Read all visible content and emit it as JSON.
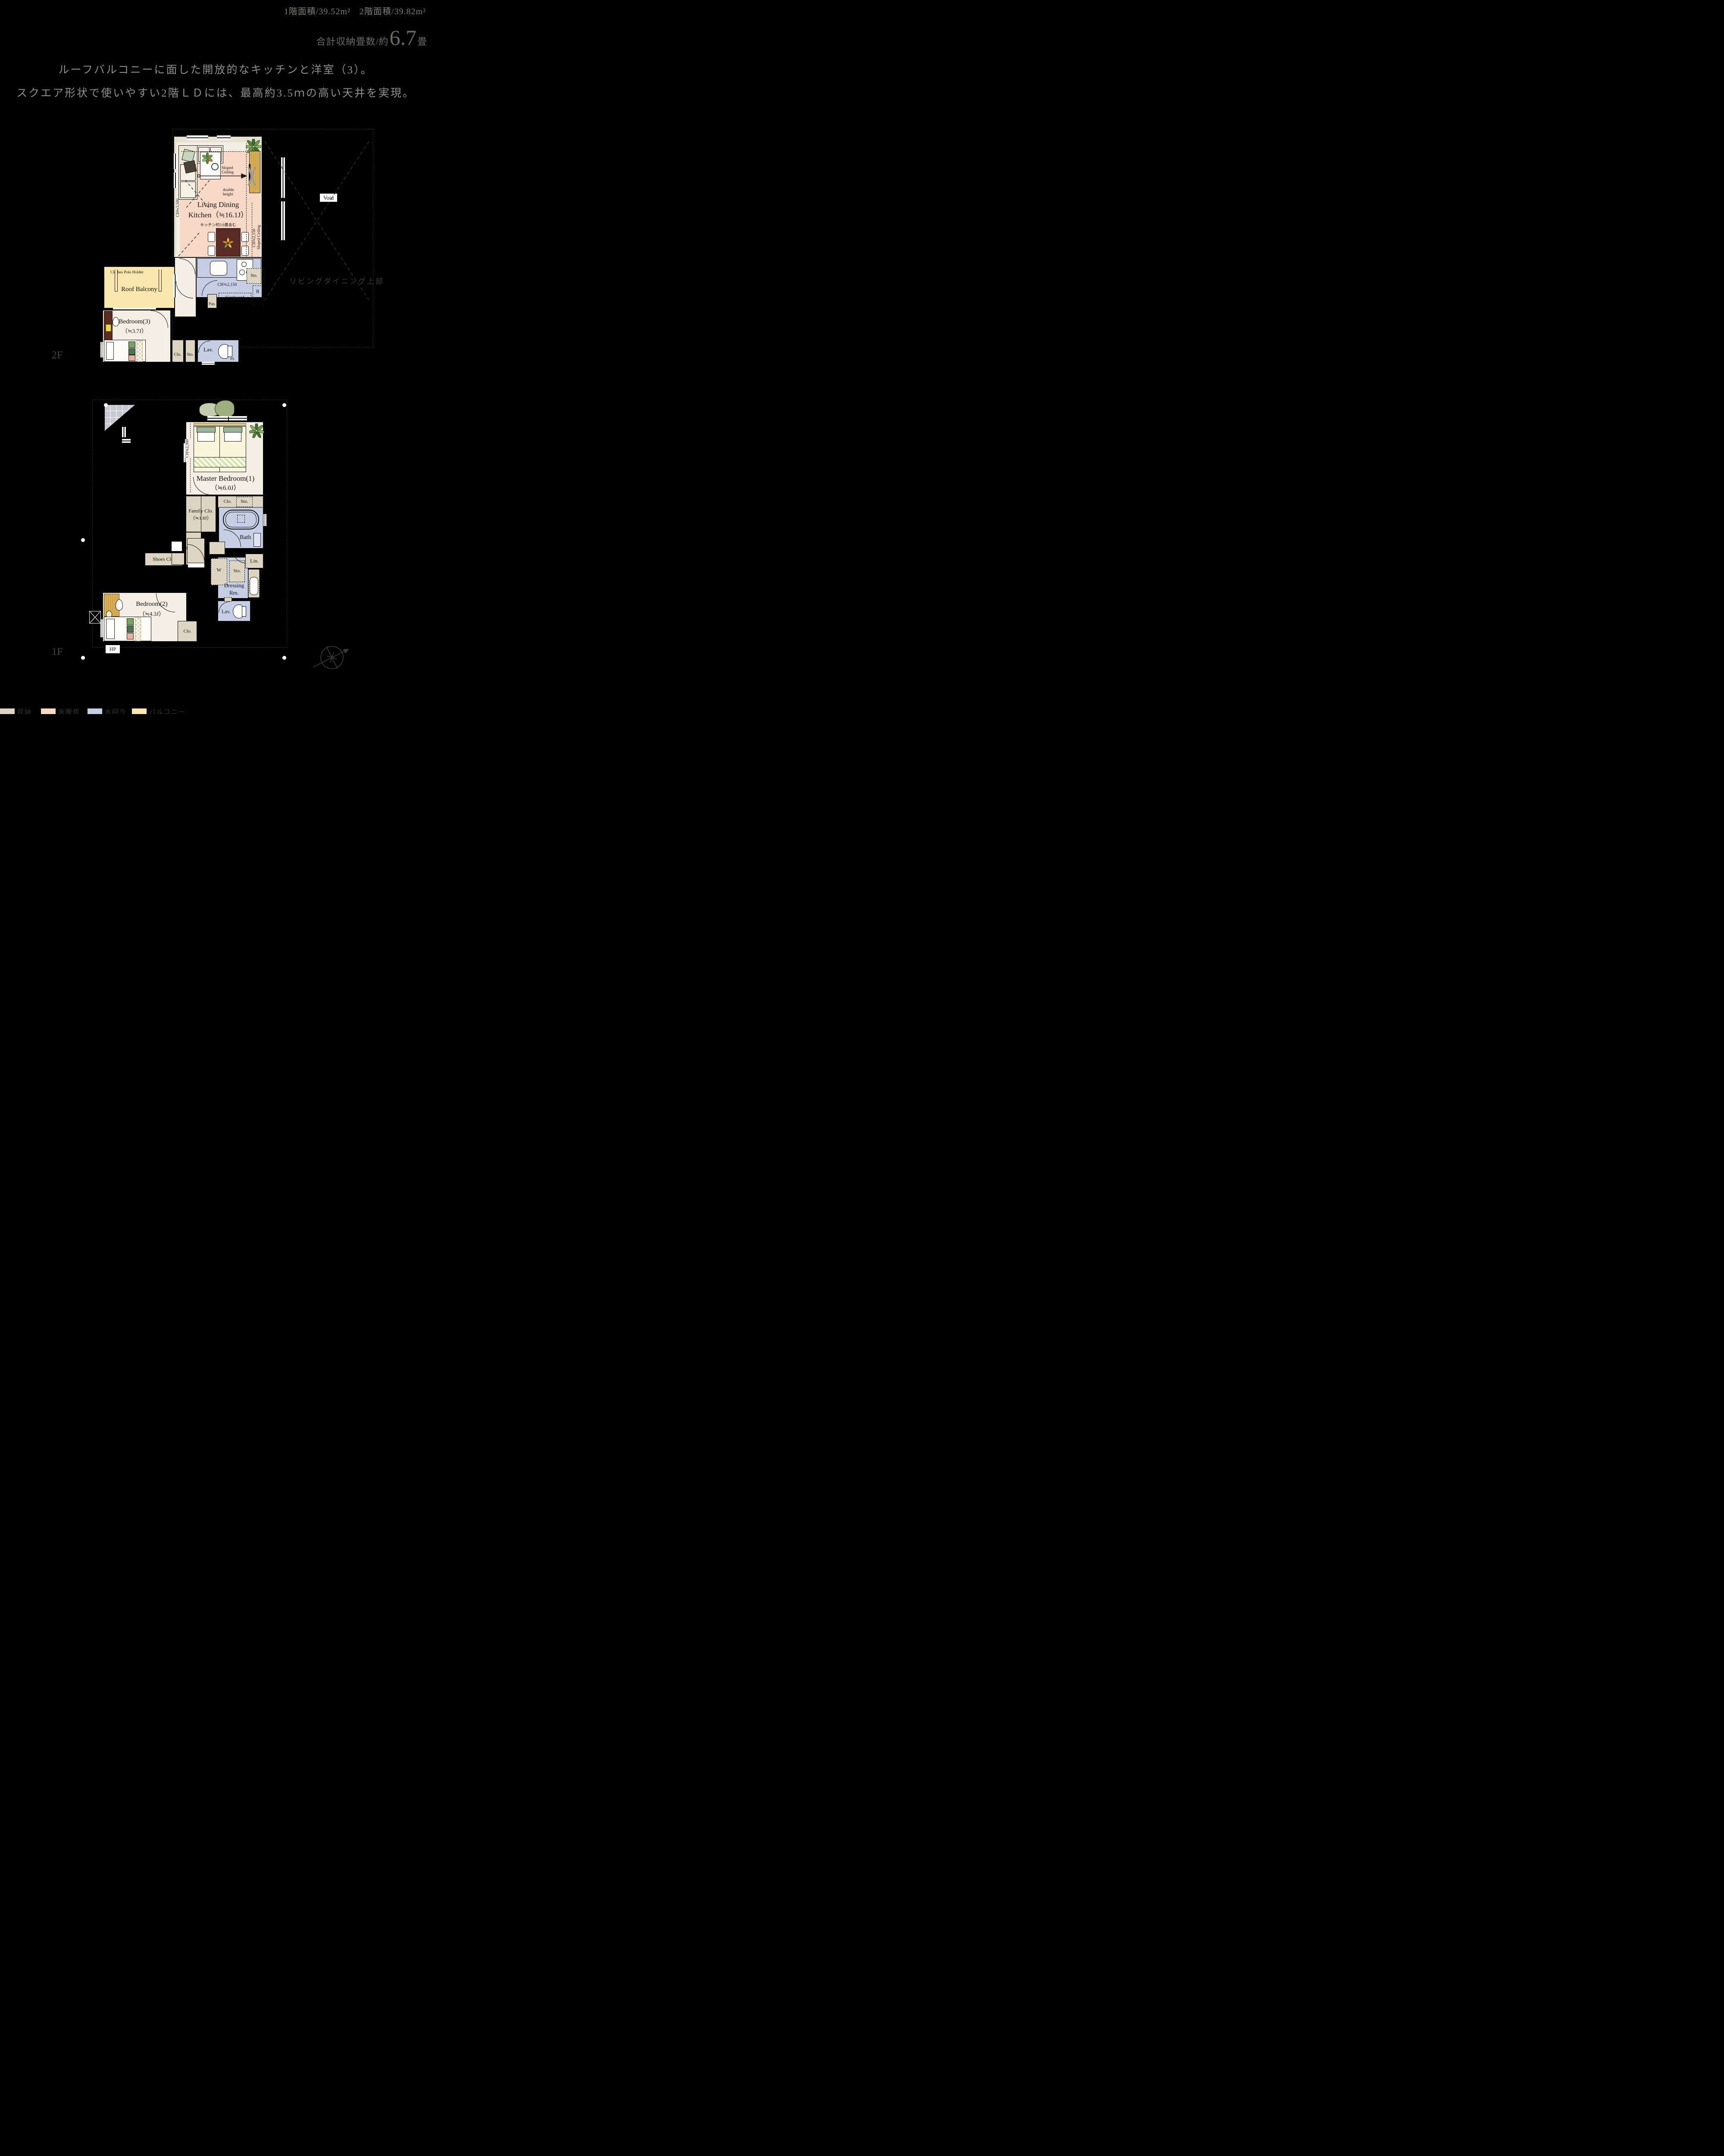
{
  "header": {
    "area_line": "1階面積/39.52m²　2階面積/39.82m²",
    "storage_prefix": "合計収納畳数/約",
    "storage_value": "6.7",
    "storage_unit": "畳",
    "headline_line1": "ルーフバルコニーに面した開放的なキッチンと洋室（3）。",
    "headline_line2": "スクエア形状で使いやすい2階ＬＤには、最高約3.5ｍの高い天井を実現。"
  },
  "floor2": {
    "label": "2F",
    "ldk": {
      "name_line1": "Living Dining",
      "name_line2": "Kitchen（≒16.1J）",
      "note": "キッチン約3.6畳含む",
      "ch_left": "CH≒3,500",
      "ch_right": "CH≒2,150",
      "sloped_right": "Sloped Ceiling",
      "sloped_1": "Sloped",
      "sloped_2": "Ceiling",
      "double_1": "double",
      "double_2": "height"
    },
    "kitchen": {
      "ch": "CH≒2,150",
      "ch_side": "CH≒1,950",
      "sto": "Sto.",
      "pan": "Pan.",
      "cupboard": "Cupboard",
      "fridge": "R"
    },
    "balcony": {
      "name": "Roof Balcony",
      "pole": "Clothes Pole Holder"
    },
    "bedroom3": {
      "name": "Bedroom(3)",
      "size": "（≒3.7J）"
    },
    "closets": {
      "clo": "Clo.",
      "sto": "Sto."
    },
    "lav": {
      "name": "Lav.",
      "ps": "PS"
    },
    "void": {
      "name": "Void",
      "upper": "リビングダイニング上部"
    }
  },
  "floor1": {
    "label": "1F",
    "master": {
      "name": "Master Bedroom(1)",
      "size": "（≒6.0J）",
      "ch": "CH≒2,300"
    },
    "closets": {
      "clo": "Clo.",
      "sto": "Sto."
    },
    "family_clo": {
      "name": "Family Clo.",
      "size": "（≒1.8J）"
    },
    "bath": {
      "name": "Bath"
    },
    "entrance": {
      "shoes": "Shoes Clo."
    },
    "utility": {
      "w": "W",
      "sto": "Sto.",
      "lin": "Lin."
    },
    "dressing": {
      "line1": "Dressing",
      "line2": "Rm."
    },
    "bedroom2": {
      "name": "Bedroom(2)",
      "size": "（≒4.3J）",
      "clo": "Clo."
    },
    "lav": {
      "name": "Lav."
    },
    "hp": "HP"
  },
  "legend": {
    "items": [
      {
        "label": "収納",
        "color": "#ddd5c1"
      },
      {
        "label": "床暖房",
        "color": "#f8d8c7"
      },
      {
        "label": "水回り",
        "color": "#c5cee4"
      },
      {
        "label": "バルコニー",
        "color": "#fae7ad"
      }
    ]
  }
}
